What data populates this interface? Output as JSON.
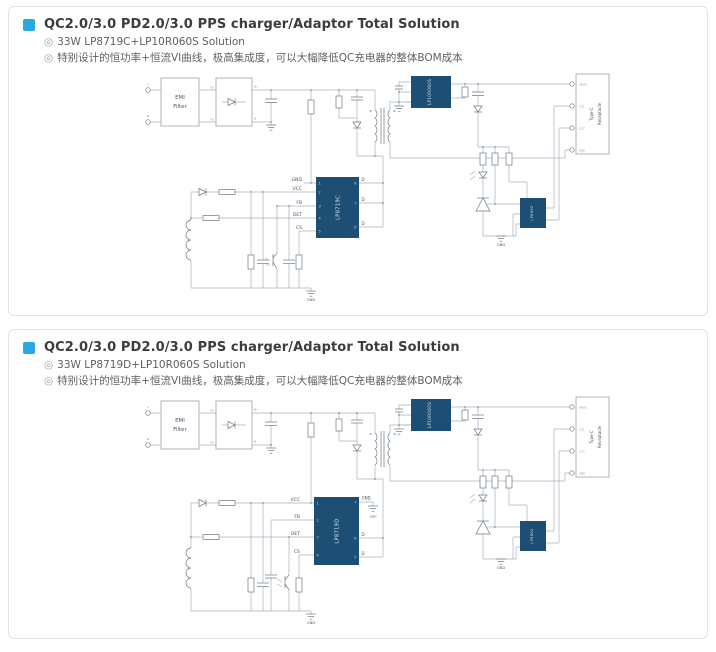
{
  "ui": {
    "bullet_marker": "◎"
  },
  "colors": {
    "accent_blue": "#29a9e1",
    "ic_navy": "#1d4e73",
    "wire_gray": "#a6b0bb"
  },
  "panels": [
    {
      "title": "QC2.0/3.0 PD2.0/3.0 PPS charger/Adaptor Total Solution",
      "bullets": [
        "33W LP8719C+LP10R060S Solution",
        "特别设计的恒功率+恒流VI曲线，极高集成度，可以大幅降低QC充电器的整体BOM成本"
      ],
      "circuit": {
        "terminal_l": "L",
        "terminal_n": "N",
        "emi": [
          "EMI",
          "Filter"
        ],
        "ac": "AC",
        "bplus": "B+",
        "bminus": "B-",
        "main_ic": {
          "name": "LP8719C",
          "left_pins": [
            {
              "no": "1",
              "label": "GND"
            },
            {
              "no": "2",
              "label": "VCC"
            },
            {
              "no": "3",
              "label": "FB"
            },
            {
              "no": "4",
              "label": "DET"
            },
            {
              "no": "5",
              "label": "CS"
            }
          ],
          "right_pins": [
            {
              "no": "8",
              "label": "D"
            },
            {
              "no": "7",
              "label": "D"
            },
            {
              "no": "6",
              "label": "D"
            }
          ]
        },
        "sr_ic": "LP10R060S",
        "protocol_ic": "LP8902",
        "connector": {
          "name": [
            "Type-C",
            "Receptacle"
          ],
          "pins": [
            "VBUS",
            "CC1",
            "CC2",
            "GND"
          ]
        },
        "gnd": "GND"
      }
    },
    {
      "title": "QC2.0/3.0 PD2.0/3.0 PPS charger/Adaptor Total Solution",
      "bullets": [
        "33W LP8719D+LP10R060S Solution",
        "特别设计的恒功率+恒流VI曲线，极高集成度，可以大幅降低QC充电器的整体BOM成本"
      ],
      "circuit": {
        "terminal_l": "L",
        "terminal_n": "N",
        "emi": [
          "EMI",
          "Filter"
        ],
        "ac": "AC",
        "bplus": "B+",
        "bminus": "B-",
        "main_ic": {
          "name": "LP8719D",
          "left_pins": [
            {
              "no": "1",
              "label": "VCC"
            },
            {
              "no": "2",
              "label": "FB"
            },
            {
              "no": "3",
              "label": "DET"
            },
            {
              "no": "4",
              "label": "CS"
            }
          ],
          "right_pins": [
            {
              "no": "7",
              "label": "GND"
            },
            {
              "no": "6",
              "label": "D"
            },
            {
              "no": "5",
              "label": "D"
            }
          ]
        },
        "sr_ic": "LP10R060S",
        "protocol_ic": "LP8902",
        "connector": {
          "name": [
            "Type-C",
            "Receptacle"
          ],
          "pins": [
            "VBUS",
            "CC1",
            "CC2",
            "GND"
          ]
        },
        "gnd": "GND"
      }
    }
  ]
}
